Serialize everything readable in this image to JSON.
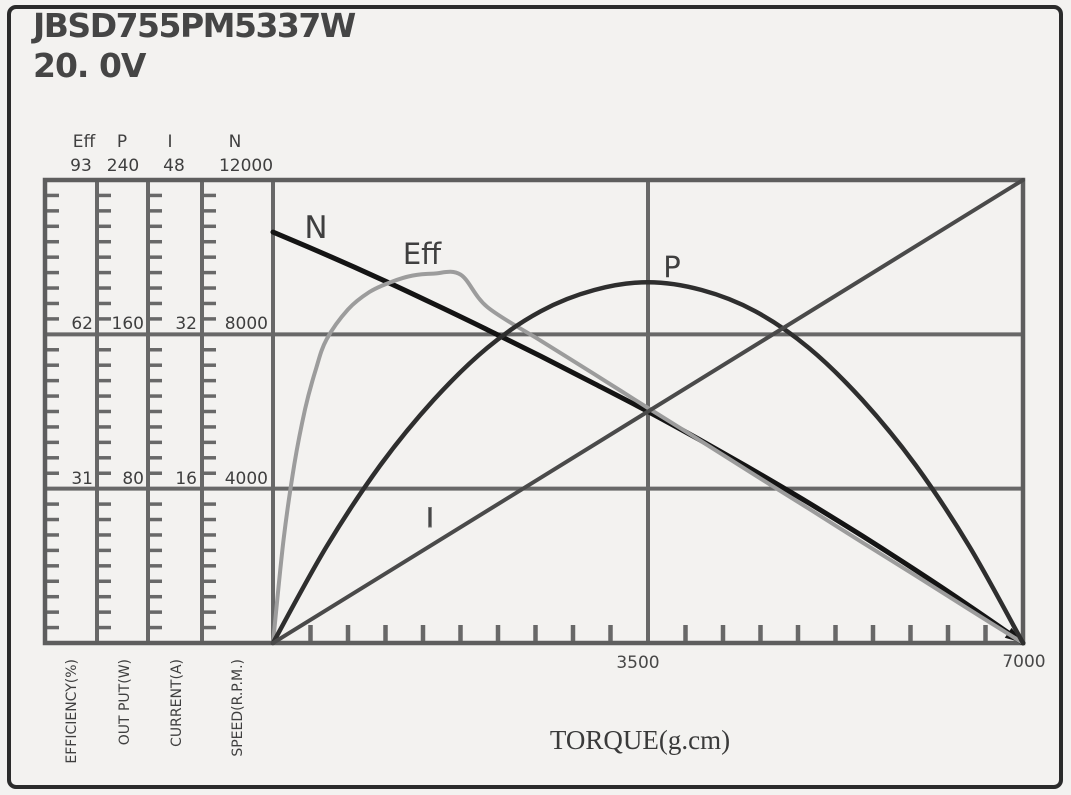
{
  "title": {
    "model": "JBSD755PM5337W",
    "voltage": "20. 0V"
  },
  "colors": {
    "grid": "#686868",
    "frame": "#5e5e5e",
    "curve_n": "#141414",
    "curve_eff": "#9c9c9c",
    "curve_p": "#2e2e2e",
    "curve_i": "#4a4a4a",
    "text": "#3f3f3f"
  },
  "scales": [
    {
      "symbol": "Eff",
      "max_label": "93",
      "t1": "62",
      "t2": "31",
      "name": "EFFICIENCY(%)",
      "max": 93
    },
    {
      "symbol": "P",
      "max_label": "240",
      "t1": "160",
      "t2": "80",
      "name": "OUT PUT(W)",
      "max": 240
    },
    {
      "symbol": "I",
      "max_label": "48",
      "t1": "32",
      "t2": "16",
      "name": "CURRENT(A)",
      "max": 48
    },
    {
      "symbol": "N",
      "max_label": "12000",
      "t1": "8000",
      "t2": "4000",
      "name": "SPEED(R.P.M.)",
      "max": 12000
    }
  ],
  "x_axis": {
    "title": "TORQUE(g.cm)",
    "mid_label": "3500",
    "end_label": "7000",
    "max": 7000,
    "minor_step": 350,
    "major_line_at": 3500
  },
  "chart_data": {
    "type": "line",
    "title": "JBSD755PM5337W 20.0V motor performance curves",
    "xlabel": "TORQUE(g.cm)",
    "xlim": [
      0,
      7000
    ],
    "grid": "major lines at 1/3 and 2/3 of each left scale; vertical line at torque 3500",
    "legend_position": "labels beside curves",
    "series": [
      {
        "name": "N",
        "axis": "SPEED(R.P.M.)",
        "ymax": 12000,
        "color": "#141414",
        "width": 5,
        "smooth": true,
        "arrow_end": true,
        "points": [
          [
            0,
            10650
          ],
          [
            500,
            10060
          ],
          [
            1000,
            9440
          ],
          [
            1500,
            8790
          ],
          [
            2000,
            8120
          ],
          [
            2500,
            7430
          ],
          [
            3000,
            6720
          ],
          [
            3500,
            6000
          ],
          [
            4000,
            5240
          ],
          [
            4500,
            4450
          ],
          [
            5000,
            3630
          ],
          [
            5500,
            2775
          ],
          [
            6000,
            1885
          ],
          [
            6500,
            960
          ],
          [
            7000,
            0
          ]
        ]
      },
      {
        "name": "Eff",
        "axis": "EFFICIENCY(%)",
        "ymax": 93,
        "color": "#9c9c9c",
        "width": 4,
        "smooth": true,
        "arrow_end": false,
        "points": [
          [
            0,
            0
          ],
          [
            100,
            21
          ],
          [
            200,
            36
          ],
          [
            300,
            47
          ],
          [
            400,
            55
          ],
          [
            500,
            61
          ],
          [
            700,
            67
          ],
          [
            900,
            70.5
          ],
          [
            1100,
            72.5
          ],
          [
            1300,
            73.8
          ],
          [
            1500,
            74.2
          ],
          [
            1750,
            74
          ],
          [
            2000,
            67.5
          ],
          [
            2500,
            60.7
          ],
          [
            3000,
            54
          ],
          [
            3500,
            47.2
          ],
          [
            4000,
            40.5
          ],
          [
            4500,
            33.7
          ],
          [
            5000,
            27
          ],
          [
            5500,
            20.2
          ],
          [
            6000,
            13.5
          ],
          [
            6500,
            6.7
          ],
          [
            7000,
            0
          ]
        ]
      },
      {
        "name": "P",
        "axis": "OUT PUT(W)",
        "ymax": 240,
        "color": "#2e2e2e",
        "width": 4.5,
        "smooth": true,
        "arrow_end": false,
        "points": [
          [
            0,
            0
          ],
          [
            500,
            50
          ],
          [
            1000,
            92
          ],
          [
            1500,
            126
          ],
          [
            2000,
            153
          ],
          [
            2500,
            172
          ],
          [
            3000,
            183
          ],
          [
            3500,
            187
          ],
          [
            4000,
            183
          ],
          [
            4500,
            172
          ],
          [
            5000,
            153
          ],
          [
            5500,
            126
          ],
          [
            6000,
            92
          ],
          [
            6500,
            50
          ],
          [
            7000,
            0
          ]
        ]
      },
      {
        "name": "I",
        "axis": "CURRENT(A)",
        "ymax": 48,
        "color": "#4a4a4a",
        "width": 4,
        "smooth": false,
        "arrow_end": false,
        "points": [
          [
            0,
            0
          ],
          [
            7000,
            48
          ]
        ]
      }
    ]
  }
}
